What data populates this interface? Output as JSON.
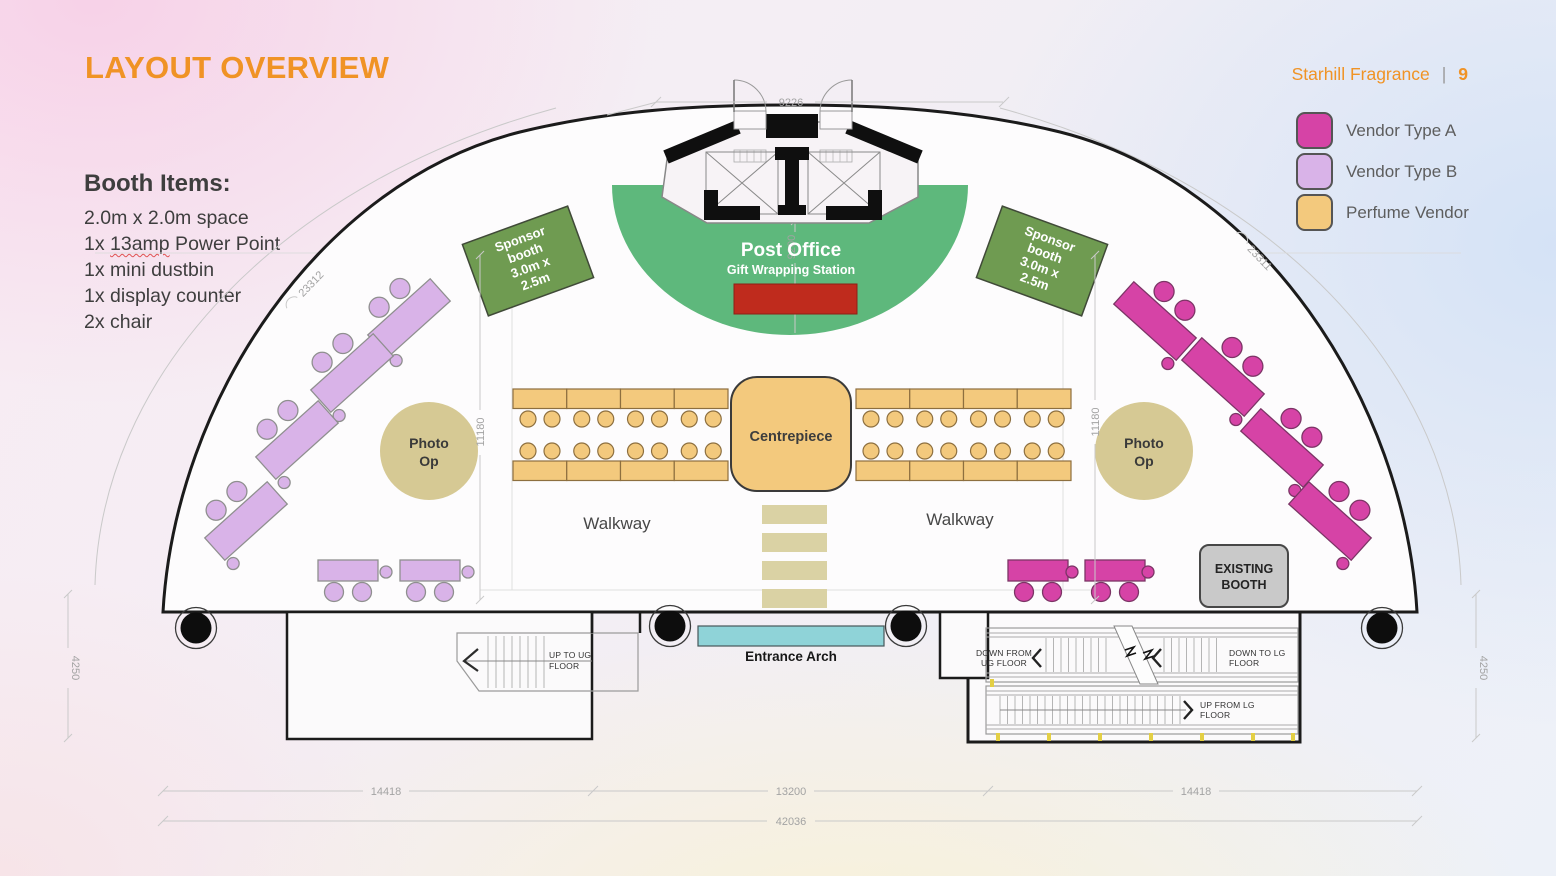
{
  "header": {
    "title": "LAYOUT OVERVIEW",
    "brand": "Starhill Fragrance",
    "divider": "|",
    "page_number": "9"
  },
  "booth_items": {
    "heading": "Booth Items:",
    "line1": "2.0m x 2.0m space",
    "line2_prefix": "1x ",
    "line2_highlight": "13amp",
    "line2_suffix": " Power Point",
    "line3": "1x mini dustbin",
    "line4": "1x display counter",
    "line5": "2x chair"
  },
  "legend": {
    "items": [
      {
        "label": "Vendor Type A",
        "color": "#d643a6"
      },
      {
        "label": "Vendor Type B",
        "color": "#d9b3e8"
      },
      {
        "label": "Perfume Vendor",
        "color": "#f3c97d"
      }
    ]
  },
  "plan": {
    "post_office": {
      "title": "Post Office",
      "subtitle": "Gift Wrapping Station"
    },
    "sponsor_booth": {
      "lines": [
        "Sponsor",
        "booth",
        "3.0m x",
        "2.5m"
      ]
    },
    "centrepiece_label": "Centrepiece",
    "walkway_left": "Walkway",
    "walkway_right": "Walkway",
    "photo_op": {
      "line1": "Photo",
      "line2": "Op"
    },
    "entrance_arch_label": "Entrance Arch",
    "existing_booth": {
      "line1": "EXISTING",
      "line2": "BOOTH"
    },
    "stairs_left": {
      "line1": "UP TO UG",
      "line2": "FLOOR"
    },
    "escalators": {
      "down_from_line1": "DOWN FROM",
      "down_from_line2": "UG FLOOR",
      "down_to_line1": "DOWN TO LG",
      "down_to_line2": "FLOOR",
      "up_from_line1": "UP FROM LG",
      "up_from_line2": "FLOOR"
    }
  },
  "dimensions": {
    "top_width": "9226",
    "post_office_depth": "9200",
    "arc_left": "23312",
    "arc_right": "23311",
    "inner_left": "11180",
    "inner_right": "11180",
    "side_left": "4250",
    "side_right": "4250",
    "bottom_left": "14418",
    "bottom_center": "13200",
    "bottom_right": "14418",
    "bottom_total": "42036"
  },
  "colors": {
    "accent_orange": "#f09325",
    "vendor_a": "#d643a6",
    "vendor_b": "#d9b3e8",
    "perfume": "#f3c97d",
    "sponsor_green": "#6f9b51",
    "station_green": "#5eb87c",
    "red_counter": "#bf2b1d",
    "entrance_cyan": "#8fd3d8",
    "steps_khaki": "#dad2a4",
    "photo_op": "#d6c994",
    "existing_gray": "#c9c9c9"
  }
}
